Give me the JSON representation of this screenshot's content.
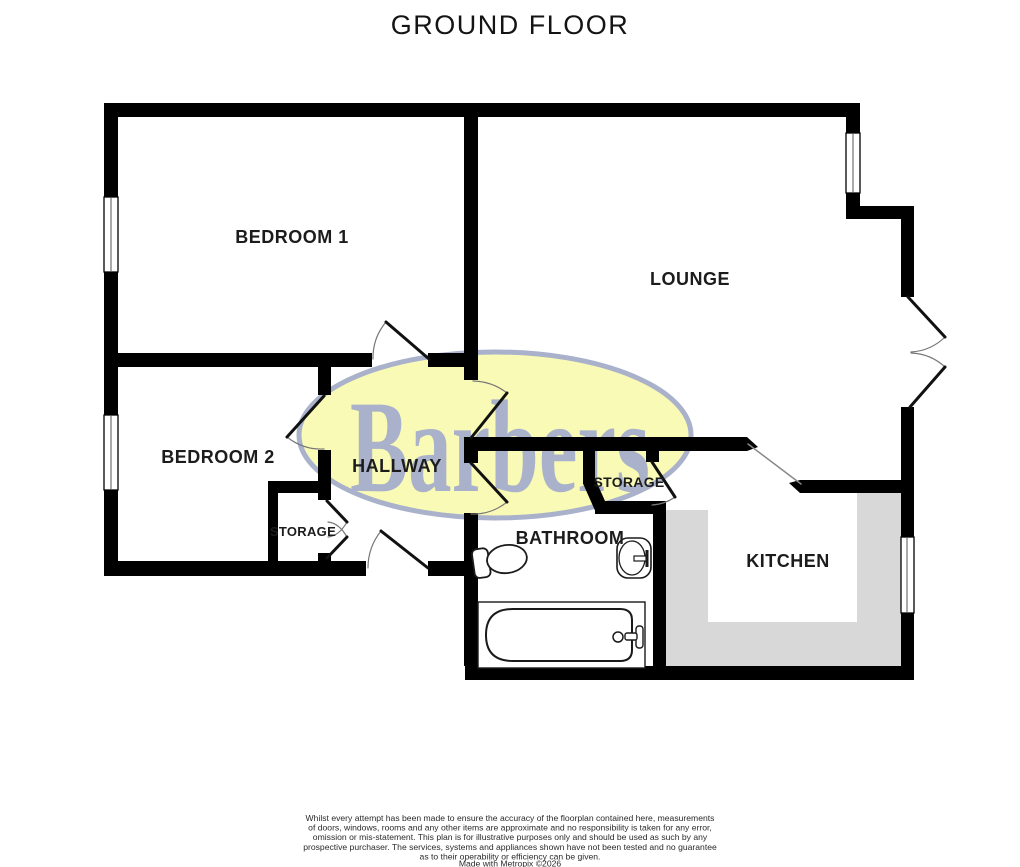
{
  "title": "GROUND FLOOR",
  "rooms": {
    "bedroom1": "BEDROOM 1",
    "lounge": "LOUNGE",
    "bedroom2": "BEDROOM 2",
    "hallway": "HALLWAY",
    "storage_hall": "STORAGE",
    "storage_kitchen": "STORAGE",
    "bathroom": "BATHROOM",
    "kitchen": "KITCHEN"
  },
  "watermark": {
    "text": "Barbers",
    "fill_color": "#f9fab5",
    "line_color": "#a9b1cb"
  },
  "colors": {
    "wall": "#000000",
    "kitchen_counter": "#d8d8d8",
    "door_arc": "#777777",
    "background": "#ffffff"
  },
  "footer": {
    "lines": [
      "Whilst every attempt has been made to ensure the accuracy of the floorplan contained here, measurements",
      "of doors, windows, rooms and any other items are approximate and no responsibility is taken for any error,",
      "omission or mis-statement. This plan is for illustrative purposes only and should be used as such by any",
      "prospective purchaser. The services, systems and appliances shown have not been tested and no guarantee",
      "as to their operability or efficiency can be given.",
      "Made with Metropix ©2026"
    ]
  }
}
